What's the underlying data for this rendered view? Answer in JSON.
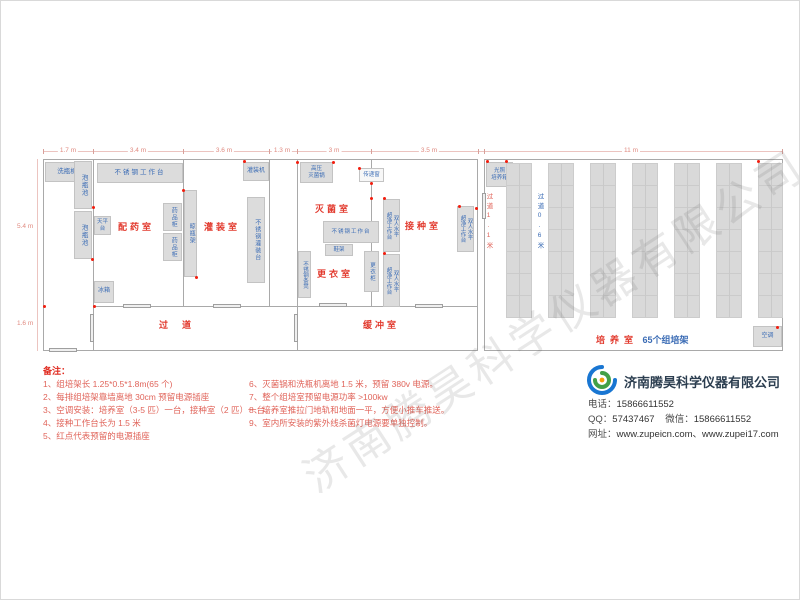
{
  "plan": {
    "rooms": {
      "peiyao": "配药室",
      "guanzhuang": "灌装室",
      "guodao": "过道",
      "miejun": "灭菌室",
      "gengyi": "更衣室",
      "jiezhong": "接种室",
      "huanchong": "缓冲室",
      "peiyang": "培养室"
    },
    "peiyang_suffix": "65个组培架",
    "equipment": {
      "xipingji": "洗瓶机",
      "paopingchi": "泡瓶池",
      "worktable": "不锈钢工作台",
      "tianpingtai": "天平台",
      "yaopingui": "药品柜",
      "liangpingjia": "晾瓶架",
      "bingxiang": "冰箱",
      "guanzhuangji": "灌装机",
      "guanzhuangtai": "不锈钢灌装台",
      "gaoya_l1": "高压",
      "gaoya_l2": "灭菌锅",
      "chuandichuang": "传递窗",
      "xiejia": "鞋架",
      "gengyigui": "更衣柜",
      "tiaodeng": "不锈钢条凳",
      "chaojing_l1": "双人水平",
      "chaojing_l2": "超净工作台",
      "guangzhao_l1": "光照",
      "guangzhao_l2": "培养箱",
      "kongtiao": "空调"
    },
    "aisles": {
      "a1": "过道1.1米",
      "a2": "过道0.6米"
    },
    "dims": {
      "top": [
        "1.7 m",
        "3.4 m",
        "3.6 m",
        "1.3 m",
        "3 m",
        "3.5 m",
        "11 m"
      ],
      "left": [
        "5.4 m",
        "1.6 m"
      ]
    }
  },
  "notes": {
    "header": "备注：",
    "left": [
      "1、组培架长 1.25*0.5*1.8m(65 个)",
      "2、每排组培架靠墙离地 30cm 预留电源插座",
      "3、空调安装：培养室（3-5 匹）一台，接种室（2 匹）一台。",
      "4、接种工作台长为 1.5 米",
      "5、红点代表预留的电源插座"
    ],
    "right": [
      "6、灭菌锅和洗瓶机离地 1.5 米，预留 380v 电源。",
      "7、整个组培室预留电源功率 >100kw",
      "8、培养室推拉门地轨和地面一平，方便小推车推送。",
      "9、室内所安装的紫外线杀菌灯电源要单独控制。"
    ]
  },
  "company": {
    "name": "济南腾昊科学仪器有限公司",
    "phone_label": "电话：",
    "phone": "15866611552",
    "qq_label": "QQ：",
    "qq": "57437467",
    "wechat_label": "微信：",
    "wechat": "15866611552",
    "web_label": "网址：",
    "websites": "www.zupeicn.com、www.zupei17.com"
  },
  "watermark": "济南腾昊科学仪器有限公司",
  "colors": {
    "room_label": "#e23a2e",
    "equipment_text": "#3b6cb5",
    "note_text": "#e0645a",
    "outlet_dot": "#f21d0e",
    "logo_blue": "#1976d2",
    "logo_green": "#43a047"
  }
}
